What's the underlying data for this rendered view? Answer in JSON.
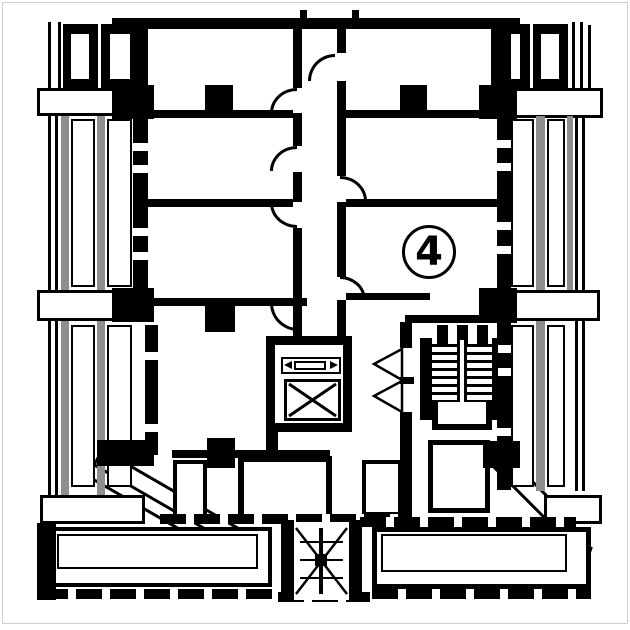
{
  "meta": {
    "drawing": "floor-plan",
    "unit_label": "4"
  },
  "colors": {
    "ink": "#000000",
    "paper": "#ffffff",
    "gray": "#8e8e8e"
  },
  "plan": {
    "diagonals": [
      {
        "n": "diag-left-band",
        "x": 102,
        "y": 448,
        "w": 160,
        "h": 20,
        "a": 30,
        "t": "dslab"
      },
      {
        "n": "diag-left-line",
        "x": 80,
        "y": 470,
        "w": 120,
        "h": 3,
        "a": 30,
        "t": "dline"
      },
      {
        "n": "diag-right-band",
        "x": 497,
        "y": 444,
        "w": 105,
        "h": 20,
        "a": 45,
        "t": "dslab"
      },
      {
        "n": "balcony-right-chamfer",
        "x": 589,
        "y": 546,
        "w": 4,
        "h": 50,
        "a": 18,
        "t": "dwall"
      }
    ],
    "rects": [
      {
        "n": "top-wall",
        "x": 112,
        "y": 18,
        "w": 408,
        "h": 11,
        "t": "wall"
      },
      {
        "n": "top-tick-left",
        "x": 300,
        "y": 10,
        "w": 7,
        "h": 8,
        "t": "wall"
      },
      {
        "n": "top-tick-right",
        "x": 352,
        "y": 10,
        "w": 7,
        "h": 8,
        "t": "wall"
      },
      {
        "n": "leftbay-thin-1",
        "x": 48,
        "y": 22,
        "w": 3,
        "h": 68,
        "t": "wall"
      },
      {
        "n": "leftbay-thin-2",
        "x": 58,
        "y": 22,
        "w": 3,
        "h": 68,
        "t": "wall"
      },
      {
        "n": "leftbay-unit-a",
        "x": 63,
        "y": 24,
        "w": 35,
        "h": 64,
        "t": "wall"
      },
      {
        "n": "leftbay-window-a",
        "x": 69,
        "y": 32,
        "w": 22,
        "h": 49,
        "t": "win"
      },
      {
        "n": "leftbay-unit-b",
        "x": 101,
        "y": 24,
        "w": 39,
        "h": 64,
        "t": "wall"
      },
      {
        "n": "leftbay-window-b",
        "x": 108,
        "y": 32,
        "w": 24,
        "h": 49,
        "t": "win"
      },
      {
        "n": "leftbay-slab-1",
        "x": 37,
        "y": 88,
        "w": 106,
        "h": 28,
        "t": "slab"
      },
      {
        "n": "leftbay-pier-1",
        "x": 112,
        "y": 85,
        "w": 42,
        "h": 34,
        "t": "wall"
      },
      {
        "n": "leftbay-line-1",
        "x": 48,
        "y": 116,
        "w": 3,
        "h": 174,
        "t": "wall"
      },
      {
        "n": "leftbay-line-2",
        "x": 55,
        "y": 116,
        "w": 3,
        "h": 174,
        "t": "wall"
      },
      {
        "n": "leftbay-mullion-1",
        "x": 61,
        "y": 116,
        "w": 8,
        "h": 174,
        "t": "gray"
      },
      {
        "n": "leftbay-window-1",
        "x": 71,
        "y": 119,
        "w": 24,
        "h": 168,
        "t": "win"
      },
      {
        "n": "leftbay-mullion-2",
        "x": 97,
        "y": 116,
        "w": 8,
        "h": 174,
        "t": "gray"
      },
      {
        "n": "leftbay-window-2",
        "x": 107,
        "y": 119,
        "w": 25,
        "h": 168,
        "t": "win"
      },
      {
        "n": "leftbay-slab-2",
        "x": 37,
        "y": 290,
        "w": 78,
        "h": 31,
        "t": "slab"
      },
      {
        "n": "leftbay-pier-2",
        "x": 112,
        "y": 288,
        "w": 42,
        "h": 34,
        "t": "wall"
      },
      {
        "n": "leftbay-line-3",
        "x": 48,
        "y": 321,
        "w": 3,
        "h": 174,
        "t": "wall"
      },
      {
        "n": "leftbay-line-4",
        "x": 55,
        "y": 321,
        "w": 3,
        "h": 174,
        "t": "wall"
      },
      {
        "n": "leftbay-mullion-3",
        "x": 61,
        "y": 321,
        "w": 8,
        "h": 174,
        "t": "gray"
      },
      {
        "n": "leftbay-window-3",
        "x": 71,
        "y": 325,
        "w": 24,
        "h": 162,
        "t": "win"
      },
      {
        "n": "leftbay-mullion-4",
        "x": 97,
        "y": 321,
        "w": 8,
        "h": 174,
        "t": "gray"
      },
      {
        "n": "leftbay-window-4",
        "x": 107,
        "y": 325,
        "w": 25,
        "h": 162,
        "t": "win"
      },
      {
        "n": "leftbay-slab-3",
        "x": 40,
        "y": 495,
        "w": 105,
        "h": 29,
        "t": "slab"
      },
      {
        "n": "leftwall-upper",
        "x": 133,
        "y": 25,
        "w": 15,
        "h": 278,
        "t": "wall"
      },
      {
        "n": "leftwall-notch-1",
        "x": 133,
        "y": 143,
        "w": 15,
        "h": 8,
        "t": "paper"
      },
      {
        "n": "leftwall-notch-2",
        "x": 133,
        "y": 165,
        "w": 15,
        "h": 8,
        "t": "paper"
      },
      {
        "n": "leftwall-notch-3",
        "x": 133,
        "y": 228,
        "w": 15,
        "h": 8,
        "t": "paper"
      },
      {
        "n": "leftwall-notch-4",
        "x": 133,
        "y": 252,
        "w": 15,
        "h": 8,
        "t": "paper"
      },
      {
        "n": "leftwall-lower",
        "x": 145,
        "y": 325,
        "w": 13,
        "h": 130,
        "t": "wall"
      },
      {
        "n": "leftwall-notch-5",
        "x": 145,
        "y": 352,
        "w": 13,
        "h": 8,
        "t": "paper"
      },
      {
        "n": "leftwall-notch-6",
        "x": 145,
        "y": 424,
        "w": 13,
        "h": 8,
        "t": "paper"
      },
      {
        "n": "rightbay-pier-1",
        "x": 479,
        "y": 85,
        "w": 38,
        "h": 34,
        "t": "wall"
      },
      {
        "n": "rightbay-slab-1",
        "x": 514,
        "y": 88,
        "w": 89,
        "h": 30,
        "t": "slab"
      },
      {
        "n": "rightbay-unit-a",
        "x": 491,
        "y": 24,
        "w": 39,
        "h": 64,
        "t": "wall"
      },
      {
        "n": "rightbay-window-a",
        "x": 498,
        "y": 32,
        "w": 24,
        "h": 49,
        "t": "win"
      },
      {
        "n": "rightbay-unit-b",
        "x": 533,
        "y": 24,
        "w": 35,
        "h": 64,
        "t": "wall"
      },
      {
        "n": "rightbay-window-b",
        "x": 539,
        "y": 32,
        "w": 22,
        "h": 49,
        "t": "win"
      },
      {
        "n": "rightbay-thin-1",
        "x": 572,
        "y": 22,
        "w": 3,
        "h": 68,
        "t": "wall"
      },
      {
        "n": "rightbay-thin-2",
        "x": 580,
        "y": 22,
        "w": 3,
        "h": 68,
        "t": "wall"
      },
      {
        "n": "rightbay-thin-3",
        "x": 588,
        "y": 25,
        "w": 3,
        "h": 65,
        "t": "wall"
      },
      {
        "n": "rightbay-window-1",
        "x": 511,
        "y": 119,
        "w": 23,
        "h": 168,
        "t": "win"
      },
      {
        "n": "rightbay-mullion-1",
        "x": 536,
        "y": 116,
        "w": 9,
        "h": 174,
        "t": "gray"
      },
      {
        "n": "rightbay-window-2",
        "x": 547,
        "y": 119,
        "w": 18,
        "h": 168,
        "t": "win"
      },
      {
        "n": "rightbay-mullion-2",
        "x": 567,
        "y": 116,
        "w": 6,
        "h": 174,
        "t": "gray"
      },
      {
        "n": "rightbay-line-1",
        "x": 575,
        "y": 116,
        "w": 3,
        "h": 174,
        "t": "wall"
      },
      {
        "n": "rightbay-line-2",
        "x": 582,
        "y": 116,
        "w": 3,
        "h": 174,
        "t": "wall"
      },
      {
        "n": "rightbay-slab-2",
        "x": 514,
        "y": 290,
        "w": 86,
        "h": 31,
        "t": "slab"
      },
      {
        "n": "rightbay-pier-2",
        "x": 479,
        "y": 288,
        "w": 38,
        "h": 34,
        "t": "wall"
      },
      {
        "n": "rightbay-window-3",
        "x": 511,
        "y": 325,
        "w": 23,
        "h": 162,
        "t": "win"
      },
      {
        "n": "rightbay-mullion-3",
        "x": 536,
        "y": 321,
        "w": 9,
        "h": 170,
        "t": "gray"
      },
      {
        "n": "rightbay-window-4",
        "x": 547,
        "y": 325,
        "w": 18,
        "h": 162,
        "t": "win"
      },
      {
        "n": "rightbay-line-3",
        "x": 575,
        "y": 321,
        "w": 3,
        "h": 170,
        "t": "wall"
      },
      {
        "n": "rightbay-line-4",
        "x": 582,
        "y": 321,
        "w": 3,
        "h": 170,
        "t": "wall"
      },
      {
        "n": "rightbay-slab-3",
        "x": 544,
        "y": 495,
        "w": 58,
        "h": 29,
        "t": "slab"
      },
      {
        "n": "rightwall",
        "x": 497,
        "y": 25,
        "w": 14,
        "h": 465,
        "t": "wall"
      },
      {
        "n": "rightwall-notch-1",
        "x": 497,
        "y": 140,
        "w": 14,
        "h": 8,
        "t": "paper"
      },
      {
        "n": "rightwall-notch-2",
        "x": 497,
        "y": 163,
        "w": 14,
        "h": 8,
        "t": "paper"
      },
      {
        "n": "rightwall-notch-3",
        "x": 497,
        "y": 222,
        "w": 14,
        "h": 8,
        "t": "paper"
      },
      {
        "n": "rightwall-notch-4",
        "x": 497,
        "y": 246,
        "w": 14,
        "h": 8,
        "t": "paper"
      },
      {
        "n": "rightwall-notch-5",
        "x": 497,
        "y": 345,
        "w": 14,
        "h": 8,
        "t": "paper"
      },
      {
        "n": "rightwall-notch-6",
        "x": 497,
        "y": 368,
        "w": 14,
        "h": 8,
        "t": "paper"
      },
      {
        "n": "rightwall-notch-7",
        "x": 497,
        "y": 428,
        "w": 14,
        "h": 8,
        "t": "paper"
      },
      {
        "n": "rightwall-notch-8",
        "x": 497,
        "y": 452,
        "w": 14,
        "h": 8,
        "t": "paper"
      },
      {
        "n": "wall1-left",
        "x": 148,
        "y": 110,
        "w": 145,
        "h": 8,
        "t": "wall"
      },
      {
        "n": "wall1-column-left",
        "x": 205,
        "y": 85,
        "w": 28,
        "h": 33,
        "t": "wall"
      },
      {
        "n": "wall1-right",
        "x": 346,
        "y": 110,
        "w": 151,
        "h": 8,
        "t": "wall"
      },
      {
        "n": "wall1-column-right",
        "x": 400,
        "y": 85,
        "w": 27,
        "h": 33,
        "t": "wall"
      },
      {
        "n": "wall2-left",
        "x": 148,
        "y": 199,
        "w": 145,
        "h": 8,
        "t": "wall"
      },
      {
        "n": "wall2-right",
        "x": 346,
        "y": 199,
        "w": 151,
        "h": 8,
        "t": "wall"
      },
      {
        "n": "wall3-left",
        "x": 148,
        "y": 298,
        "w": 159,
        "h": 8,
        "t": "wall"
      },
      {
        "n": "wall3-column-left",
        "x": 205,
        "y": 306,
        "w": 30,
        "h": 26,
        "t": "wall"
      },
      {
        "n": "wall3-right-a",
        "x": 346,
        "y": 293,
        "w": 84,
        "h": 7,
        "t": "wall"
      },
      {
        "n": "wall3-right-b",
        "x": 405,
        "y": 315,
        "w": 97,
        "h": 8,
        "t": "wall"
      },
      {
        "n": "wall3-column-right",
        "x": 486,
        "y": 288,
        "w": 31,
        "h": 35,
        "t": "wall"
      },
      {
        "n": "bottomroom-wall",
        "x": 172,
        "y": 450,
        "w": 158,
        "h": 8,
        "t": "wall"
      },
      {
        "n": "bottomroom-column",
        "x": 207,
        "y": 438,
        "w": 28,
        "h": 30,
        "t": "wall"
      },
      {
        "n": "corridor-leftwall-1",
        "x": 293,
        "y": 25,
        "w": 9,
        "h": 63,
        "t": "wall"
      },
      {
        "n": "corridor-leftwall-2",
        "x": 293,
        "y": 113,
        "w": 9,
        "h": 33,
        "t": "wall"
      },
      {
        "n": "corridor-leftwall-3",
        "x": 293,
        "y": 172,
        "w": 9,
        "h": 30,
        "t": "wall"
      },
      {
        "n": "corridor-leftwall-4",
        "x": 293,
        "y": 228,
        "w": 9,
        "h": 110,
        "t": "wall"
      },
      {
        "n": "corridor-rightwall-1",
        "x": 337,
        "y": 25,
        "w": 9,
        "h": 28,
        "t": "wall"
      },
      {
        "n": "corridor-rightwall-2",
        "x": 337,
        "y": 81,
        "w": 9,
        "h": 95,
        "t": "wall"
      },
      {
        "n": "corridor-rightwall-3",
        "x": 337,
        "y": 202,
        "w": 9,
        "h": 75,
        "t": "wall"
      },
      {
        "n": "corridor-rightwall-4",
        "x": 337,
        "y": 300,
        "w": 9,
        "h": 38,
        "t": "wall"
      },
      {
        "n": "stairhall-wall-a",
        "x": 400,
        "y": 322,
        "w": 12,
        "h": 26,
        "t": "wall"
      },
      {
        "n": "stairhall-wall-b",
        "x": 400,
        "y": 412,
        "w": 12,
        "h": 110,
        "t": "wall"
      },
      {
        "n": "stair-stub-1",
        "x": 437,
        "y": 325,
        "w": 11,
        "h": 19,
        "t": "wall"
      },
      {
        "n": "stair-stub-2",
        "x": 457,
        "y": 325,
        "w": 11,
        "h": 19,
        "t": "wall"
      },
      {
        "n": "stair-stub-3",
        "x": 477,
        "y": 325,
        "w": 11,
        "h": 19,
        "t": "wall"
      },
      {
        "n": "elevator-stub",
        "x": 266,
        "y": 428,
        "w": 12,
        "h": 32,
        "t": "wall"
      },
      {
        "n": "terrace-box-1",
        "x": 173,
        "y": 460,
        "w": 34,
        "h": 58,
        "t": "b4"
      },
      {
        "n": "terrace-box-2",
        "x": 238,
        "y": 456,
        "w": 94,
        "h": 64,
        "t": "b6"
      },
      {
        "n": "terrace-box-3",
        "x": 362,
        "y": 460,
        "w": 40,
        "h": 56,
        "t": "b4"
      },
      {
        "n": "terrace-box-4",
        "x": 428,
        "y": 440,
        "w": 62,
        "h": 73,
        "t": "b5"
      },
      {
        "n": "terrace-band-left",
        "x": 160,
        "y": 514,
        "w": 252,
        "h": 10,
        "t": "dash"
      },
      {
        "n": "terrace-band-right",
        "x": 360,
        "y": 517,
        "w": 216,
        "h": 10,
        "t": "dash"
      },
      {
        "n": "diag-left-block",
        "x": 97,
        "y": 440,
        "w": 57,
        "h": 26,
        "t": "wall"
      },
      {
        "n": "diag-right-block",
        "x": 483,
        "y": 441,
        "w": 37,
        "h": 27,
        "t": "wall"
      },
      {
        "n": "balcony-left",
        "x": 42,
        "y": 527,
        "w": 230,
        "h": 60,
        "t": "b4"
      },
      {
        "n": "balcony-left-inner",
        "x": 57,
        "y": 534,
        "w": 201,
        "h": 35,
        "t": "b2"
      },
      {
        "n": "balcony-left-line",
        "x": 42,
        "y": 583,
        "w": 230,
        "h": 4,
        "t": "wall"
      },
      {
        "n": "balcony-left-dash",
        "x": 42,
        "y": 589,
        "w": 230,
        "h": 10,
        "t": "dash"
      },
      {
        "n": "leftbay-corner",
        "x": 37,
        "y": 523,
        "w": 19,
        "h": 77,
        "t": "wall"
      },
      {
        "n": "balcony-right",
        "x": 372,
        "y": 527,
        "w": 219,
        "h": 62,
        "t": "b5"
      },
      {
        "n": "balcony-right-inner",
        "x": 381,
        "y": 534,
        "w": 186,
        "h": 38,
        "t": "b2"
      },
      {
        "n": "balcony-right-dash",
        "x": 372,
        "y": 589,
        "w": 219,
        "h": 10,
        "t": "dash"
      },
      {
        "n": "escape-band",
        "x": 278,
        "y": 592,
        "w": 92,
        "h": 10,
        "t": "dash"
      },
      {
        "n": "escape-rail-left",
        "x": 281,
        "y": 520,
        "w": 13,
        "h": 82,
        "t": "wall"
      },
      {
        "n": "escape-rail-right",
        "x": 349,
        "y": 520,
        "w": 13,
        "h": 82,
        "t": "wall"
      }
    ],
    "arcs": [
      {
        "n": "door-corridor-top",
        "x": 308,
        "y": 54,
        "w": 27,
        "h": 27,
        "c": "tl"
      },
      {
        "n": "door-left-1",
        "x": 270,
        "y": 88,
        "w": 27,
        "h": 25,
        "c": "tl"
      },
      {
        "n": "door-left-2",
        "x": 270,
        "y": 146,
        "w": 27,
        "h": 25,
        "c": "tl"
      },
      {
        "n": "door-left-3",
        "x": 270,
        "y": 203,
        "w": 27,
        "h": 25,
        "c": "bl"
      },
      {
        "n": "door-right-1",
        "x": 340,
        "y": 176,
        "w": 27,
        "h": 25,
        "c": "tr"
      },
      {
        "n": "door-right-2",
        "x": 340,
        "y": 276,
        "w": 26,
        "h": 24,
        "c": "tr"
      },
      {
        "n": "door-bottomroom",
        "x": 270,
        "y": 303,
        "w": 28,
        "h": 28,
        "c": "bl"
      }
    ]
  }
}
